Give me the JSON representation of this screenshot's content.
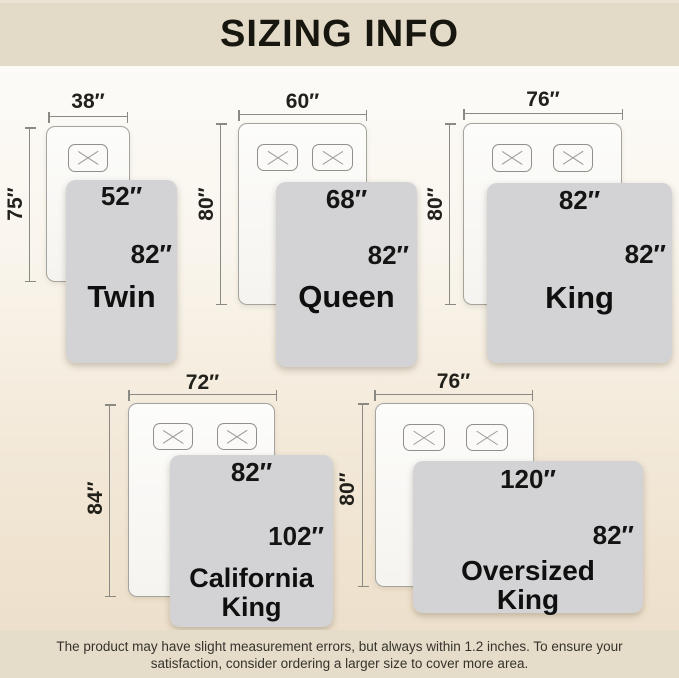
{
  "header": {
    "title": "SIZING INFO"
  },
  "footer": {
    "line1": "The product may have slight measurement errors, but always within 1.2 inches. To ensure your",
    "line2": "satisfaction, consider ordering a larger size to cover more area."
  },
  "colors": {
    "band": "#e4dac8",
    "background_bottom": "#ecdfca",
    "blanket": "#d3d3d5",
    "text": "#141414",
    "dimension_line": "#8b8984"
  },
  "diagrams": [
    {
      "name": "Twin",
      "mattress_width": "38″",
      "mattress_length": "75″",
      "blanket_width": "52″",
      "blanket_length": "82″",
      "pillow_count": 1
    },
    {
      "name": "Queen",
      "mattress_width": "60″",
      "mattress_length": "80″",
      "blanket_width": "68″",
      "blanket_length": "82″",
      "pillow_count": 2
    },
    {
      "name": "King",
      "mattress_width": "76″",
      "mattress_length": "80″",
      "blanket_width": "82″",
      "blanket_length": "82″",
      "pillow_count": 2
    },
    {
      "name": "California King",
      "name_line1": "California",
      "name_line2": "King",
      "mattress_width": "72″",
      "mattress_length": "84″",
      "blanket_width": "82″",
      "blanket_length": "102″",
      "pillow_count": 2
    },
    {
      "name": "Oversized King",
      "name_line1": "Oversized",
      "name_line2": "King",
      "mattress_width": "76″",
      "mattress_length": "80″",
      "blanket_width": "120″",
      "blanket_length": "82″",
      "pillow_count": 2
    }
  ]
}
